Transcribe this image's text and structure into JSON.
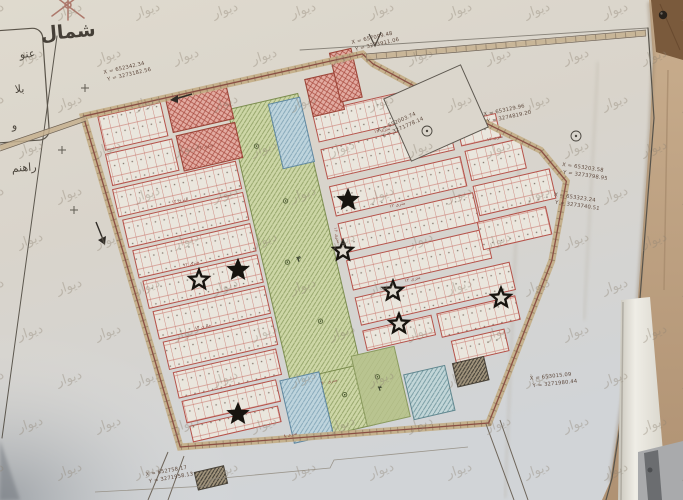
{
  "photo": {
    "watermark_text": "دیوار",
    "north_label": "شمال",
    "legend_items": [
      {
        "t": "عنو",
        "x": 20,
        "y": 58
      },
      {
        "t": "بلا",
        "x": 15,
        "y": 93
      },
      {
        "t": "و",
        "x": 12,
        "y": 129
      },
      {
        "t": "راهنم",
        "x": 12,
        "y": 172
      }
    ]
  },
  "map": {
    "block_labels": [
      {
        "t": "۴",
        "x": 298,
        "y": 252,
        "s": 8
      },
      {
        "t": "۴",
        "x": 348,
        "y": 396,
        "s": 7
      }
    ],
    "street_labels": [
      {
        "t": "۲۴ متری",
        "x": 232,
        "y": 120,
        "r": 0
      },
      {
        "t": "۱۲ متری",
        "x": 195,
        "y": 167,
        "r": 0
      },
      {
        "t": "۱۲ متری",
        "x": 192,
        "y": 231,
        "r": 0
      },
      {
        "t": "۱۲ متری",
        "x": 189,
        "y": 295,
        "r": 0
      },
      {
        "t": "۱۶ متری",
        "x": 339,
        "y": 235,
        "r": 90
      },
      {
        "t": "۱۲ متری",
        "x": 408,
        "y": 144,
        "r": 0
      },
      {
        "t": "۱۲ متری",
        "x": 406,
        "y": 220,
        "r": 0
      },
      {
        "t": "۱۲ متری",
        "x": 404,
        "y": 296,
        "r": 0
      },
      {
        "t": "۲۰ متری",
        "x": 300,
        "y": 377,
        "r": 0
      },
      {
        "t": "۱۶ متری",
        "x": 516,
        "y": 177,
        "r": 0
      },
      {
        "t": "۸ متری",
        "x": 250,
        "y": 420,
        "r": 0
      }
    ],
    "coord_labels": [
      {
        "x": 104,
        "y": 74,
        "r": -13,
        "l1": "X = 652342.34",
        "l2": "Y = 3273182.56"
      },
      {
        "x": 352,
        "y": 44,
        "r": -13,
        "l1": "X = 657099.48",
        "l2": "Y = 3273911.06"
      },
      {
        "x": 484,
        "y": 116,
        "r": -12,
        "l1": "X = 653129.96",
        "l2": "Y = 3274819.20"
      },
      {
        "x": 562,
        "y": 166,
        "r": 8,
        "l1": "X = 653203.58",
        "l2": "Y = 3273798.95"
      },
      {
        "x": 554,
        "y": 196,
        "r": 8,
        "l1": "X = 653323.24",
        "l2": "Y = 3273740.51"
      },
      {
        "x": 530,
        "y": 380,
        "r": -6,
        "l1": "X = 653015.09",
        "l2": "Y = 3271980.44"
      },
      {
        "x": 146,
        "y": 476,
        "r": -10,
        "l1": "X = 652758.17",
        "l2": "Y = 3271958.13"
      },
      {
        "x": 378,
        "y": 132,
        "r": -24,
        "l1": "X = 652003.74",
        "l2": "Y = 3271778.14"
      }
    ],
    "stars": [
      {
        "x": 348,
        "y": 200,
        "f": 1
      },
      {
        "x": 343,
        "y": 251,
        "f": 0
      },
      {
        "x": 238,
        "y": 270,
        "f": 1
      },
      {
        "x": 199,
        "y": 280,
        "f": 0
      },
      {
        "x": 393,
        "y": 291,
        "f": 0
      },
      {
        "x": 399,
        "y": 324,
        "f": 0
      },
      {
        "x": 501,
        "y": 298,
        "f": 0
      },
      {
        "x": 238,
        "y": 414,
        "f": 1
      }
    ],
    "blocks": [
      [
        "res",
        134,
        66,
        64,
        34
      ],
      [
        "res",
        133,
        104,
        68,
        32
      ],
      [
        "res",
        132,
        140,
        126,
        28
      ],
      [
        "res",
        135,
        172,
        123,
        28
      ],
      [
        "res",
        138,
        204,
        120,
        28
      ],
      [
        "res",
        141,
        236,
        117,
        28
      ],
      [
        "res",
        144,
        268,
        114,
        28
      ],
      [
        "res",
        147,
        300,
        111,
        28
      ],
      [
        "res",
        150,
        332,
        105,
        26
      ],
      [
        "res",
        152,
        362,
        96,
        22
      ],
      [
        "res",
        154,
        388,
        90,
        16
      ],
      [
        "res",
        344,
        110,
        126,
        30
      ],
      [
        "res",
        344,
        148,
        130,
        30
      ],
      [
        "res",
        344,
        186,
        134,
        30
      ],
      [
        "res",
        344,
        224,
        138,
        30
      ],
      [
        "res",
        344,
        262,
        142,
        30
      ],
      [
        "res",
        344,
        300,
        158,
        28
      ],
      [
        "res",
        344,
        334,
        70,
        20
      ],
      [
        "res",
        420,
        334,
        80,
        24
      ],
      [
        "res",
        428,
        364,
        54,
        22
      ],
      [
        "res",
        482,
        152,
        40,
        24
      ],
      [
        "res",
        484,
        182,
        56,
        30
      ],
      [
        "res",
        484,
        218,
        78,
        30
      ],
      [
        "res",
        480,
        254,
        70,
        28
      ],
      [
        "green",
        262,
        88,
        72,
        280
      ],
      [
        "green",
        292,
        366,
        42,
        62
      ],
      [
        "greenflat",
        327,
        356,
        44,
        72
      ],
      [
        "blue",
        303,
        92,
        32,
        66
      ],
      [
        "blue",
        252,
        364,
        40,
        64
      ],
      [
        "teal",
        374,
        386,
        42,
        46
      ],
      [
        "red",
        204,
        64,
        62,
        34
      ],
      [
        "red",
        206,
        102,
        60,
        36
      ],
      [
        "red",
        344,
        76,
        32,
        38
      ],
      [
        "red",
        374,
        56,
        22,
        50
      ],
      [
        "dark",
        424,
        386,
        32,
        24
      ],
      [
        "dark",
        148,
        434,
        30,
        18
      ]
    ],
    "trees": [
      {
        "x": 282,
        "y": 130
      },
      {
        "x": 298,
        "y": 190
      },
      {
        "x": 286,
        "y": 250
      },
      {
        "x": 305,
        "y": 315
      },
      {
        "x": 312,
        "y": 392
      },
      {
        "x": 348,
        "y": 382
      }
    ],
    "colors": {
      "plot_line": "#b5524a",
      "road_band": "#c3ad85",
      "green": "#cdd6a6",
      "green_flat": "#b9c490",
      "blue": "#bed4dd",
      "teal": "#c2d6d8",
      "red": "#e2aba1",
      "dark": "#a1947c",
      "paper": "#dcd7cd",
      "star": "#17140f"
    },
    "watermark_grid": {
      "dx": 78,
      "dy": 46,
      "alt_offset": 39,
      "font": 13,
      "rot": -18,
      "opacity": 0.38,
      "color": "#8f8474"
    }
  }
}
